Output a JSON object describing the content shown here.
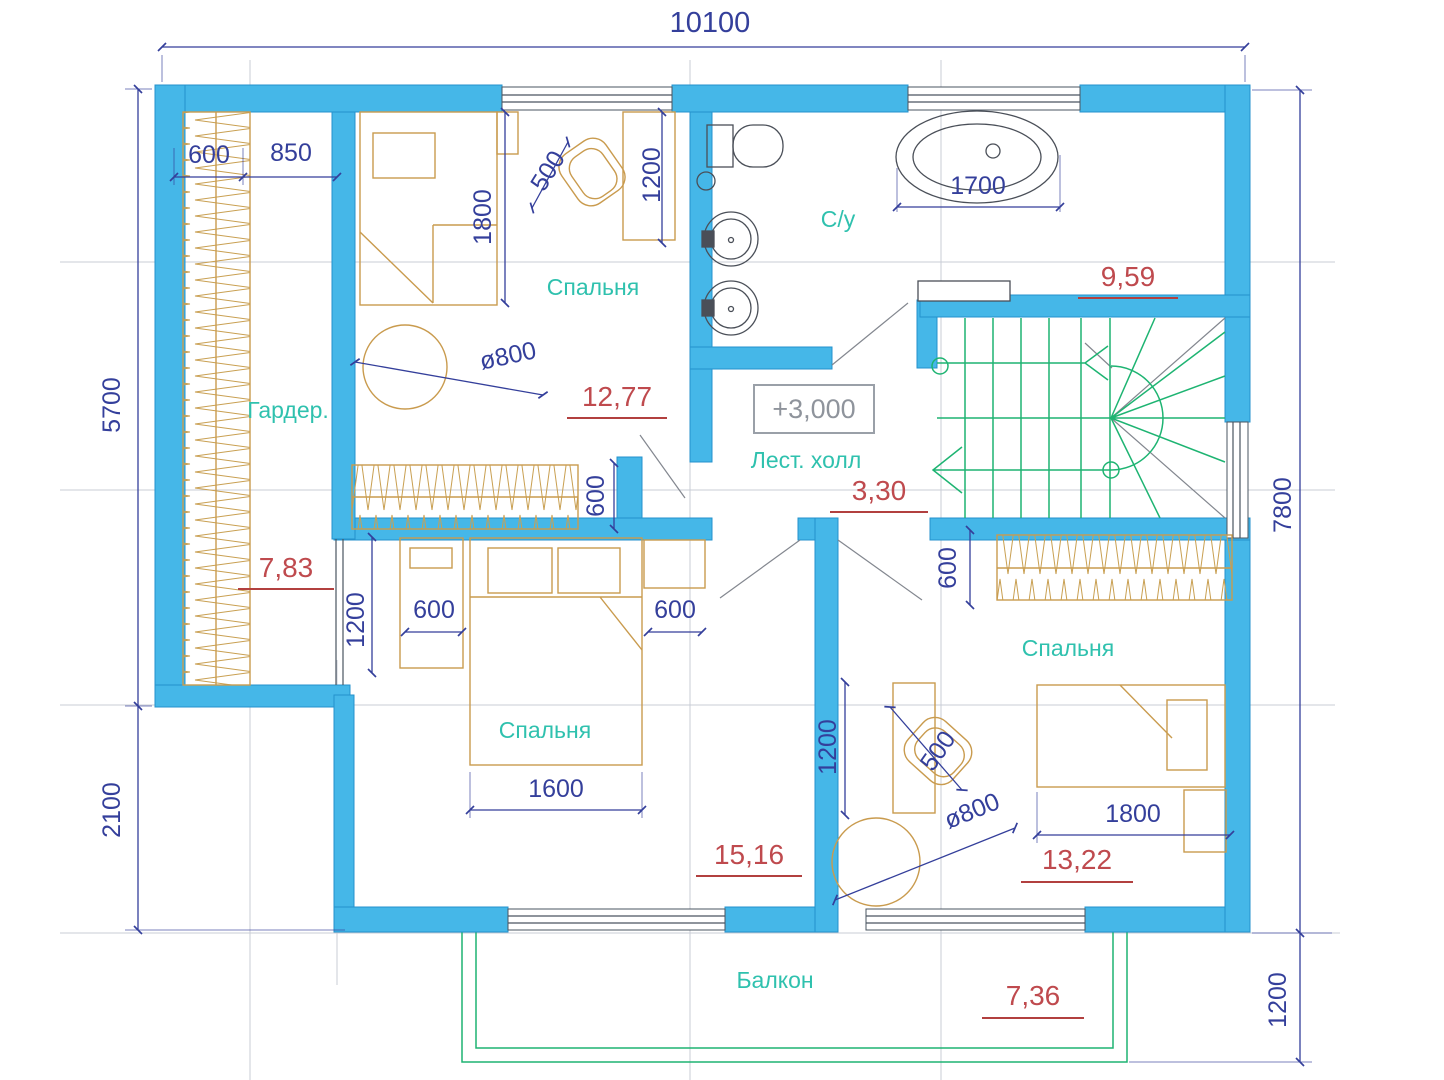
{
  "title": "Floor plan, second level (+3,000)",
  "colors": {
    "wall": "#45b7e8",
    "wall_edge": "#2492cc",
    "dimension": "#343f9b",
    "room_label": "#2fc1ae",
    "area_value": "#bf4a4e",
    "area_line": "#b2403f",
    "furniture": "#c99b4e",
    "fixture": "#4a4f58",
    "stairs": "#1eb472",
    "grid": "#c9ccd6",
    "elevation": "#8f949c",
    "window": "#4a5560",
    "swing": "#83878f"
  },
  "rooms": {
    "wardrobe": {
      "label": "Гардер.",
      "area": "7,83"
    },
    "bedroom_top": {
      "label": "Спальня",
      "area": "12,77"
    },
    "bathroom": {
      "label": "С/у",
      "area": "9,59"
    },
    "stair_hall": {
      "label": "Лест. холл",
      "area": "3,30",
      "elevation": "+3,000"
    },
    "bedroom_bottom": {
      "label": "Спальня",
      "area": "15,16"
    },
    "bedroom_right": {
      "label": "Спальня",
      "area": "13,22"
    },
    "balcony": {
      "label": "Балкон",
      "area": "7,36"
    }
  },
  "dimensions": {
    "overall_top": "10100",
    "left_upper": "5700",
    "left_lower": "2100",
    "right_main": "7800",
    "right_balcony": "1200",
    "wardrobe_width": "600",
    "wardrobe_to_wall": "850",
    "bed1_length": "1800",
    "chair1": "500",
    "desk1": "1200",
    "tub_length": "1700",
    "table1_diameter": "ø800",
    "closet1_depth": "600",
    "dresser_height": "1200",
    "dresser_width": "600",
    "nightstand_width": "600",
    "bed2_width": "1600",
    "closet2_depth": "600",
    "desk2": "1200",
    "chair2": "500",
    "table2_diameter": "ø800",
    "bed3_length": "1800"
  }
}
